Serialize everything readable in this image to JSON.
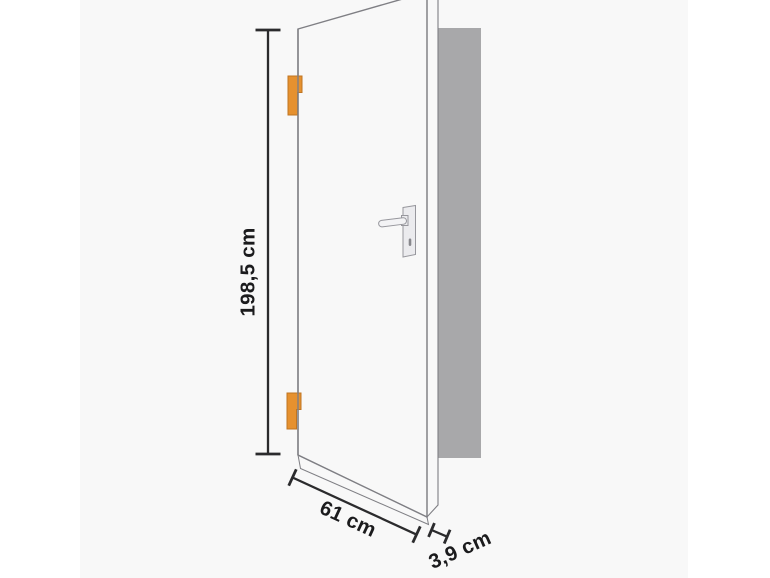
{
  "diagram": {
    "subject": "door-dimension-diagram",
    "dimensions": {
      "height_label": "198,5 cm",
      "width_label": "61 cm",
      "thickness_label": "3,9 cm"
    },
    "colors": {
      "canvas_margin": "#ffffff",
      "photo_background": "#f8f8f8",
      "frame_silhouette": "#a8a8aa",
      "door_face": "#fdfdfe",
      "door_edge_face": "#f2f2f4",
      "door_bottom_face": "#fafafb",
      "door_outline": "#7f7f84",
      "dimension_line": "#2b2b2d",
      "label_text": "#1b1b1d",
      "hinge_fill": "#e6912f",
      "hinge_stroke": "#bf7522",
      "hardware_fill": "#ebebee",
      "hardware_stroke": "#97979d",
      "keyhole": "#87878c"
    }
  }
}
